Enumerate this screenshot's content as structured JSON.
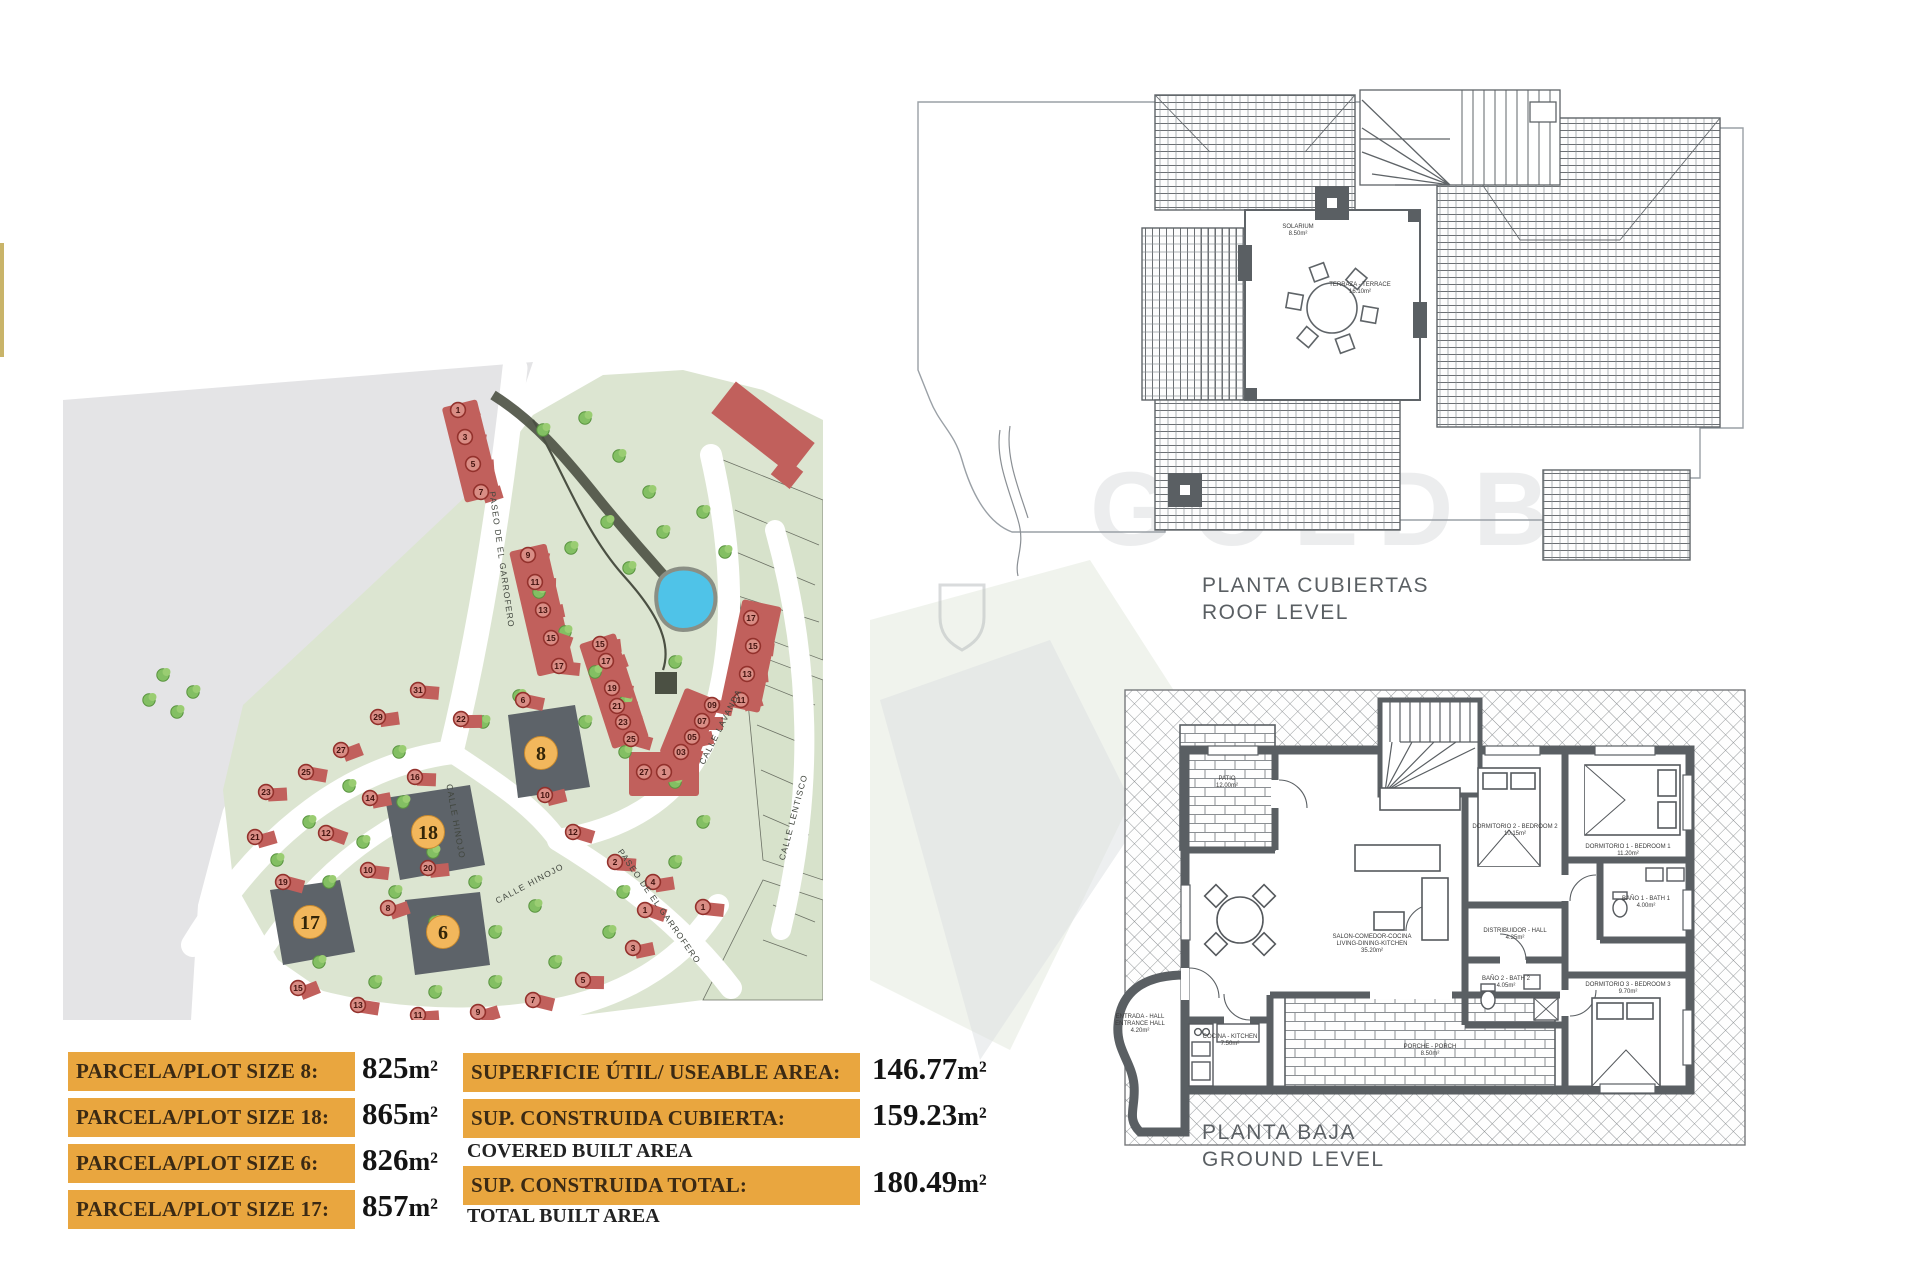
{
  "page": {
    "watermark": "GOLDBR"
  },
  "colors": {
    "orange": "#E9A63F",
    "estate_green": "#DCE5D1",
    "bg_gray": "#E4E4E6",
    "road_white": "#FFFFFF",
    "house_red": "#C1605C",
    "circle_red": "#93312C",
    "featured_plot_gray": "#5D6369",
    "featured_circle_orange": "#F2B75C",
    "pool_blue": "#4FC3E8",
    "wall_gray": "#5A5F63",
    "gold_strip": "#C9B469"
  },
  "site_plan": {
    "streets": [
      {
        "label": "PASEO DE EL GARROFERO",
        "x": 436,
        "y": 200,
        "rot": 82
      },
      {
        "label": "CALLE LAVANDA",
        "x": 660,
        "y": 368,
        "rot": -63
      },
      {
        "label": "CALLE LENTISCO",
        "x": 733,
        "y": 458,
        "rot": -75
      },
      {
        "label": "CALLE HINOJO",
        "x": 390,
        "y": 462,
        "rot": 80
      },
      {
        "label": "CALLE HINOJO",
        "x": 468,
        "y": 526,
        "rot": -28
      },
      {
        "label": "PASEO DE EL GARROFERO",
        "x": 594,
        "y": 548,
        "rot": 55
      }
    ],
    "featured_plots": [
      {
        "number": "8",
        "cx": 478,
        "cy": 393
      },
      {
        "number": "18",
        "cx": 365,
        "cy": 472
      },
      {
        "number": "6",
        "cx": 380,
        "cy": 572
      },
      {
        "number": "17",
        "cx": 247,
        "cy": 562
      }
    ],
    "houses": [
      {
        "n": "1",
        "x": 395,
        "y": 50
      },
      {
        "n": "3",
        "x": 402,
        "y": 77
      },
      {
        "n": "5",
        "x": 410,
        "y": 104
      },
      {
        "n": "7",
        "x": 418,
        "y": 132
      },
      {
        "n": "9",
        "x": 465,
        "y": 195
      },
      {
        "n": "11",
        "x": 472,
        "y": 222
      },
      {
        "n": "13",
        "x": 480,
        "y": 250
      },
      {
        "n": "15",
        "x": 488,
        "y": 278
      },
      {
        "n": "17",
        "x": 496,
        "y": 306
      },
      {
        "n": "15",
        "x": 537,
        "y": 284
      },
      {
        "n": "17",
        "x": 543,
        "y": 301
      },
      {
        "n": "19",
        "x": 549,
        "y": 328
      },
      {
        "n": "21",
        "x": 554,
        "y": 346
      },
      {
        "n": "23",
        "x": 560,
        "y": 362
      },
      {
        "n": "25",
        "x": 568,
        "y": 379
      },
      {
        "n": "27",
        "x": 581,
        "y": 412
      },
      {
        "n": "1",
        "x": 601,
        "y": 412
      },
      {
        "n": "17",
        "x": 688,
        "y": 258
      },
      {
        "n": "15",
        "x": 690,
        "y": 286
      },
      {
        "n": "13",
        "x": 684,
        "y": 314
      },
      {
        "n": "11",
        "x": 678,
        "y": 340
      },
      {
        "n": "09",
        "x": 649,
        "y": 345
      },
      {
        "n": "07",
        "x": 639,
        "y": 361
      },
      {
        "n": "05",
        "x": 629,
        "y": 377
      },
      {
        "n": "03",
        "x": 618,
        "y": 392
      },
      {
        "n": "31",
        "x": 355,
        "y": 330
      },
      {
        "n": "29",
        "x": 315,
        "y": 357
      },
      {
        "n": "27",
        "x": 278,
        "y": 390
      },
      {
        "n": "25",
        "x": 243,
        "y": 412
      },
      {
        "n": "23",
        "x": 203,
        "y": 432
      },
      {
        "n": "21",
        "x": 192,
        "y": 477
      },
      {
        "n": "19",
        "x": 220,
        "y": 522
      },
      {
        "n": "16",
        "x": 352,
        "y": 417
      },
      {
        "n": "14",
        "x": 307,
        "y": 438
      },
      {
        "n": "12",
        "x": 263,
        "y": 473
      },
      {
        "n": "10",
        "x": 305,
        "y": 510
      },
      {
        "n": "20",
        "x": 365,
        "y": 508
      },
      {
        "n": "8",
        "x": 325,
        "y": 548
      },
      {
        "n": "6",
        "x": 460,
        "y": 340
      },
      {
        "n": "22",
        "x": 398,
        "y": 359
      },
      {
        "n": "10",
        "x": 482,
        "y": 435
      },
      {
        "n": "12",
        "x": 510,
        "y": 472
      },
      {
        "n": "2",
        "x": 552,
        "y": 502
      },
      {
        "n": "4",
        "x": 590,
        "y": 522
      },
      {
        "n": "15",
        "x": 235,
        "y": 628
      },
      {
        "n": "13",
        "x": 295,
        "y": 645
      },
      {
        "n": "11",
        "x": 355,
        "y": 655
      },
      {
        "n": "9",
        "x": 415,
        "y": 652
      },
      {
        "n": "7",
        "x": 470,
        "y": 640
      },
      {
        "n": "5",
        "x": 520,
        "y": 620
      },
      {
        "n": "3",
        "x": 570,
        "y": 588
      },
      {
        "n": "1",
        "x": 582,
        "y": 550
      },
      {
        "n": "1",
        "x": 640,
        "y": 547
      }
    ],
    "trees": [
      [
        480,
        70
      ],
      [
        522,
        58
      ],
      [
        556,
        96
      ],
      [
        586,
        132
      ],
      [
        544,
        162
      ],
      [
        508,
        188
      ],
      [
        566,
        208
      ],
      [
        640,
        152
      ],
      [
        662,
        192
      ],
      [
        600,
        172
      ],
      [
        476,
        232
      ],
      [
        502,
        272
      ],
      [
        532,
        312
      ],
      [
        562,
        342
      ],
      [
        612,
        302
      ],
      [
        100,
        315
      ],
      [
        130,
        332
      ],
      [
        114,
        352
      ],
      [
        86,
        340
      ],
      [
        336,
        392
      ],
      [
        286,
        426
      ],
      [
        246,
        462
      ],
      [
        214,
        500
      ],
      [
        340,
        442
      ],
      [
        300,
        482
      ],
      [
        266,
        522
      ],
      [
        370,
        492
      ],
      [
        332,
        532
      ],
      [
        412,
        522
      ],
      [
        372,
        562
      ],
      [
        432,
        572
      ],
      [
        472,
        546
      ],
      [
        256,
        602
      ],
      [
        312,
        622
      ],
      [
        372,
        632
      ],
      [
        432,
        622
      ],
      [
        492,
        602
      ],
      [
        546,
        572
      ],
      [
        420,
        362
      ],
      [
        456,
        336
      ],
      [
        522,
        362
      ],
      [
        562,
        392
      ],
      [
        612,
        422
      ],
      [
        640,
        462
      ],
      [
        612,
        502
      ],
      [
        560,
        532
      ]
    ]
  },
  "plot_table": {
    "rows": [
      {
        "label": "PARCELA/PLOT SIZE 8:",
        "value": "825",
        "unit": "m²"
      },
      {
        "label": "PARCELA/PLOT SIZE 18:",
        "value": "865",
        "unit": "m²"
      },
      {
        "label": "PARCELA/PLOT SIZE 6:",
        "value": "826",
        "unit": "m²"
      },
      {
        "label": "PARCELA/PLOT SIZE 17:",
        "value": "857",
        "unit": "m²"
      }
    ]
  },
  "area_table": {
    "rows": [
      {
        "label": "SUPERFICIE ÚTIL/ USEABLE AREA:",
        "sub": "",
        "value": "146.77",
        "unit": "m²"
      },
      {
        "label": "SUP. CONSTRUIDA CUBIERTA:",
        "sub": "COVERED BUILT AREA",
        "value": "159.23",
        "unit": "m²"
      },
      {
        "label": "SUP. CONSTRUIDA TOTAL:",
        "sub": "TOTAL BUILT AREA",
        "value": "180.49",
        "unit": "m²"
      }
    ]
  },
  "roof_plan": {
    "title": "PLANTA CUBIERTAS",
    "subtitle": "ROOF LEVEL",
    "labels": [
      {
        "lines": [
          "SOLARIUM",
          "8.50m²"
        ],
        "x": 398,
        "y": 188
      },
      {
        "lines": [
          "TERRAZA - TERRACE",
          "16.10m²"
        ],
        "x": 460,
        "y": 246
      }
    ]
  },
  "ground_plan": {
    "title": "PLANTA BAJA",
    "subtitle": "GROUND LEVEL",
    "labels": [
      {
        "lines": [
          "PATIO",
          "12.00m²"
        ],
        "x": 287,
        "y": 100
      },
      {
        "lines": [
          "SALON-COMEDOR-COCINA",
          "LIVING-DINING-KITCHEN",
          "35.20m²"
        ],
        "x": 432,
        "y": 258
      },
      {
        "lines": [
          "DISTRIBUIDOR - HALL",
          "4.35m²"
        ],
        "x": 575,
        "y": 252
      },
      {
        "lines": [
          "DORMITORIO 1 - BEDROOM 1",
          "11.20m²"
        ],
        "x": 688,
        "y": 168
      },
      {
        "lines": [
          "DORMITORIO 2 - BEDROOM 2",
          "10.15m²"
        ],
        "x": 575,
        "y": 148
      },
      {
        "lines": [
          "DORMITORIO 3 - BEDROOM 3",
          "9.70m²"
        ],
        "x": 688,
        "y": 306
      },
      {
        "lines": [
          "BAÑO 1 - BATH 1",
          "4.00m²"
        ],
        "x": 706,
        "y": 220
      },
      {
        "lines": [
          "BAÑO 2 - BATH 2",
          "4.05m²"
        ],
        "x": 566,
        "y": 300
      },
      {
        "lines": [
          "COCINA - KITCHEN",
          "7.50m²"
        ],
        "x": 290,
        "y": 358
      },
      {
        "lines": [
          "ENTRADA - HALL",
          "ENTRANCE HALL",
          "4.20m²"
        ],
        "x": 200,
        "y": 338
      },
      {
        "lines": [
          "PORCHE - PORCH",
          "8.50m²"
        ],
        "x": 490,
        "y": 368
      }
    ]
  }
}
